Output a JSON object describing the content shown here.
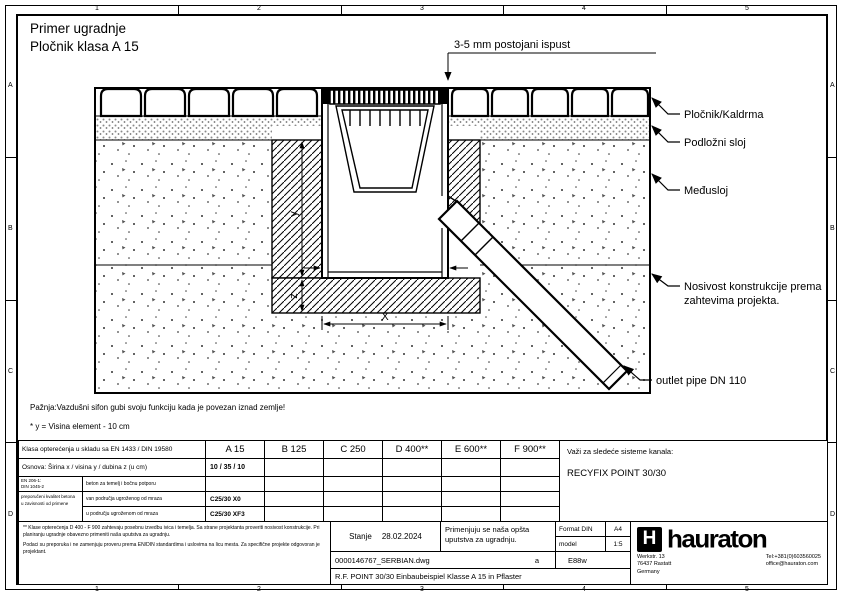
{
  "page": {
    "title_line1": "Primer ugradnje",
    "title_line2": "Pločnik klasa A 15"
  },
  "ruler": {
    "top": [
      "1",
      "2",
      "3",
      "4",
      "5"
    ],
    "side": [
      "A",
      "B",
      "C",
      "D"
    ]
  },
  "drawing": {
    "top_dimension_note": "3-5 mm postojani ispust",
    "callouts": {
      "paving": "Pločnik/Kaldrma",
      "bedding": "Podložni sloj",
      "interlayer": "Međusloj",
      "bearing_line1": "Nosivost konstrukcije prema",
      "bearing_line2": "zahtevima projekta.",
      "outlet": "outlet pipe DN 110"
    },
    "dimensions": {
      "vertical": "y",
      "vertical_lower": "z",
      "horizontal": "X"
    },
    "notes": {
      "warning": "Pažnja:Vazdušni sifon gubi svoju funkciju kada je povezan iznad zemlje!",
      "height_note": "* y = Visina element - 10 cm"
    }
  },
  "table": {
    "load_class_row": {
      "label": "Klasa opterećenja u skladu sa EN 1433 / DIN 19580",
      "classes": [
        "A 15",
        "B 125",
        "C 250",
        "D 400**",
        "E 600**",
        "F 900**"
      ]
    },
    "dimensions_row": {
      "label": "Osnova: Širina x / visina y / dubina z (u cm)",
      "value": "10 / 35 / 10"
    },
    "concrete": {
      "standard_line1": "EN 206-1:",
      "standard_line2": "DIN 1045-2",
      "quality_label_line1": "preporučeni kvalitet betona",
      "quality_label_line2": "u zavisnosti od primene",
      "rows": [
        {
          "label": "beton za temelj i bočnu potporu",
          "value": ""
        },
        {
          "label": "van područja ugroženog od mraza",
          "value": "C25/30 X0"
        },
        {
          "label": "u području ugroženom od mraza",
          "value": "C25/30 XF3"
        }
      ]
    },
    "systems": {
      "label": "Važi za sledeće sisteme kanala:",
      "value": "RECYFIX POINT 30/30"
    },
    "small_print_1": "** Klase opterećenja D 400 - F 900 zahtevaju posebnu izvedbu ivica i temelja. Sa strane projektanta proveriti nosivost konstrukcije. Pri planiranju ugradnje obavezno primeniti naša uputstva za ugradnju.",
    "small_print_2": "Podaci su preporuka i ne zamenjuju proveru prema EN/DIN standardima i uslovima na licu mesta. Za specifične projekte odgovoran je projektant.",
    "status": {
      "label": "Stanje",
      "value": "28.02.2024"
    },
    "instructions": "Primenjuju se naša opšta uputstva za ugradnju.",
    "format": {
      "label": "Format DIN",
      "value": "A4"
    },
    "scale": {
      "label": "model",
      "value": "1:5"
    },
    "file": {
      "name": "0000146767_SERBIAN.dwg",
      "revision": "a",
      "code": "E88w"
    },
    "drawing_title": "R.F. POINT 30/30 Einbaubeispiel Klasse A 15 in Pflaster",
    "company": {
      "logo_icon": "H",
      "logo": "hauraton",
      "address_line1": "Werkstr. 13",
      "address_line2": "76437 Rastatt",
      "address_line3": "Germany",
      "phone": "Tel:+381(0)603560025",
      "email": "office@hauraton.com"
    }
  }
}
